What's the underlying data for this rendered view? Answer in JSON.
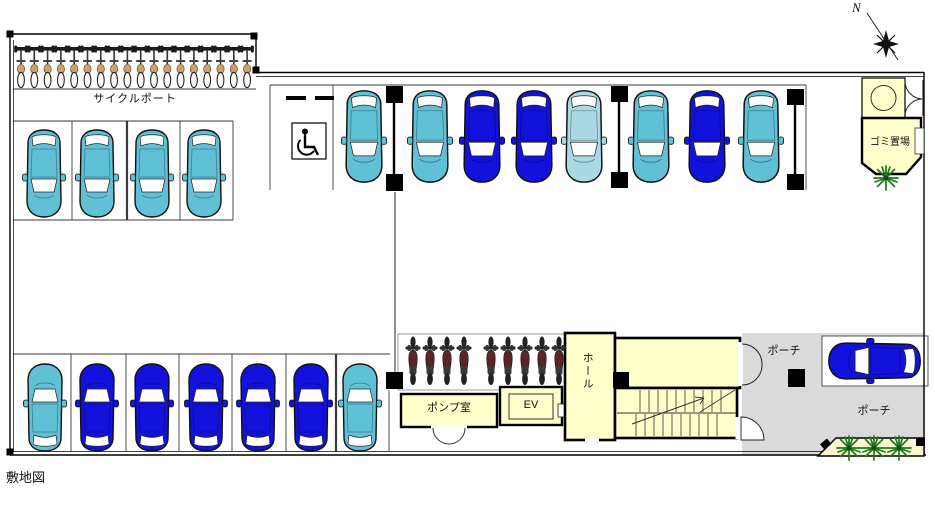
{
  "caption": "敷地図",
  "labels": {
    "cycle_port": "サイクルポート",
    "garbage_room": "ゴミ置場",
    "pump_room": "ポンプ室",
    "elevator": "EV",
    "hall": "ホール",
    "porch_upper": "ポーチ",
    "porch_lower": "ポーチ",
    "compass_north": "N"
  },
  "colors": {
    "cyan": "#5FC0D6",
    "cyan_light": "#A9DAE4",
    "blue": "#1212DC",
    "room_fill": "#FFFFCC",
    "porch_fill": "#DADADA",
    "planter_fill": "#FAF6CF",
    "plant": "#1D7A1F",
    "pillar": "#000000"
  },
  "vehicles": {
    "cars": [
      {
        "x": 44,
        "y": 174,
        "rot": 0,
        "color": "cyan",
        "s": 1
      },
      {
        "x": 97,
        "y": 174,
        "rot": 0,
        "color": "cyan",
        "s": 1
      },
      {
        "x": 152,
        "y": 174,
        "rot": 0,
        "color": "cyan",
        "s": 1
      },
      {
        "x": 204,
        "y": 174,
        "rot": 0,
        "color": "cyan",
        "s": 1
      },
      {
        "x": 364,
        "y": 137,
        "rot": 0,
        "color": "cyan",
        "s": 1.05
      },
      {
        "x": 430,
        "y": 137,
        "rot": 0,
        "color": "cyan",
        "s": 1.05
      },
      {
        "x": 482,
        "y": 137,
        "rot": 0,
        "color": "blue",
        "s": 1.05
      },
      {
        "x": 534,
        "y": 137,
        "rot": 0,
        "color": "blue",
        "s": 1.05
      },
      {
        "x": 584,
        "y": 137,
        "rot": 0,
        "color": "cyan_light",
        "s": 1.05
      },
      {
        "x": 651,
        "y": 137,
        "rot": 0,
        "color": "cyan",
        "s": 1.05
      },
      {
        "x": 707,
        "y": 137,
        "rot": 0,
        "color": "blue",
        "s": 1.05
      },
      {
        "x": 761,
        "y": 137,
        "rot": 0,
        "color": "cyan",
        "s": 1.05
      },
      {
        "x": 45,
        "y": 407,
        "rot": 180,
        "color": "cyan",
        "s": 1
      },
      {
        "x": 97,
        "y": 407,
        "rot": 180,
        "color": "blue",
        "s": 1
      },
      {
        "x": 152,
        "y": 407,
        "rot": 180,
        "color": "blue",
        "s": 1
      },
      {
        "x": 206,
        "y": 407,
        "rot": 180,
        "color": "blue",
        "s": 1
      },
      {
        "x": 258,
        "y": 407,
        "rot": 180,
        "color": "blue",
        "s": 1
      },
      {
        "x": 311,
        "y": 407,
        "rot": 180,
        "color": "blue",
        "s": 1
      },
      {
        "x": 360,
        "y": 407,
        "rot": 180,
        "color": "cyan",
        "s": 1
      },
      {
        "x": 874,
        "y": 361,
        "rot": 90,
        "color": "blue",
        "s": 1.05
      }
    ],
    "bicycles": {
      "count": 18,
      "x_start": 14,
      "spacing": 13.3,
      "y": 42
    },
    "motorcycles": {
      "xs": [
        405,
        422,
        439,
        456,
        483,
        500,
        517,
        534,
        551
      ],
      "y": 336
    }
  },
  "plants": [
    {
      "x": 886,
      "y": 178
    },
    {
      "x": 849,
      "y": 448
    },
    {
      "x": 874,
      "y": 448
    },
    {
      "x": 899,
      "y": 448
    }
  ],
  "parking_summary": {
    "bicycle_spaces": 18,
    "motorcycle_spaces": 9,
    "car_spaces_visible": 20,
    "accessible_space_marked": true
  }
}
